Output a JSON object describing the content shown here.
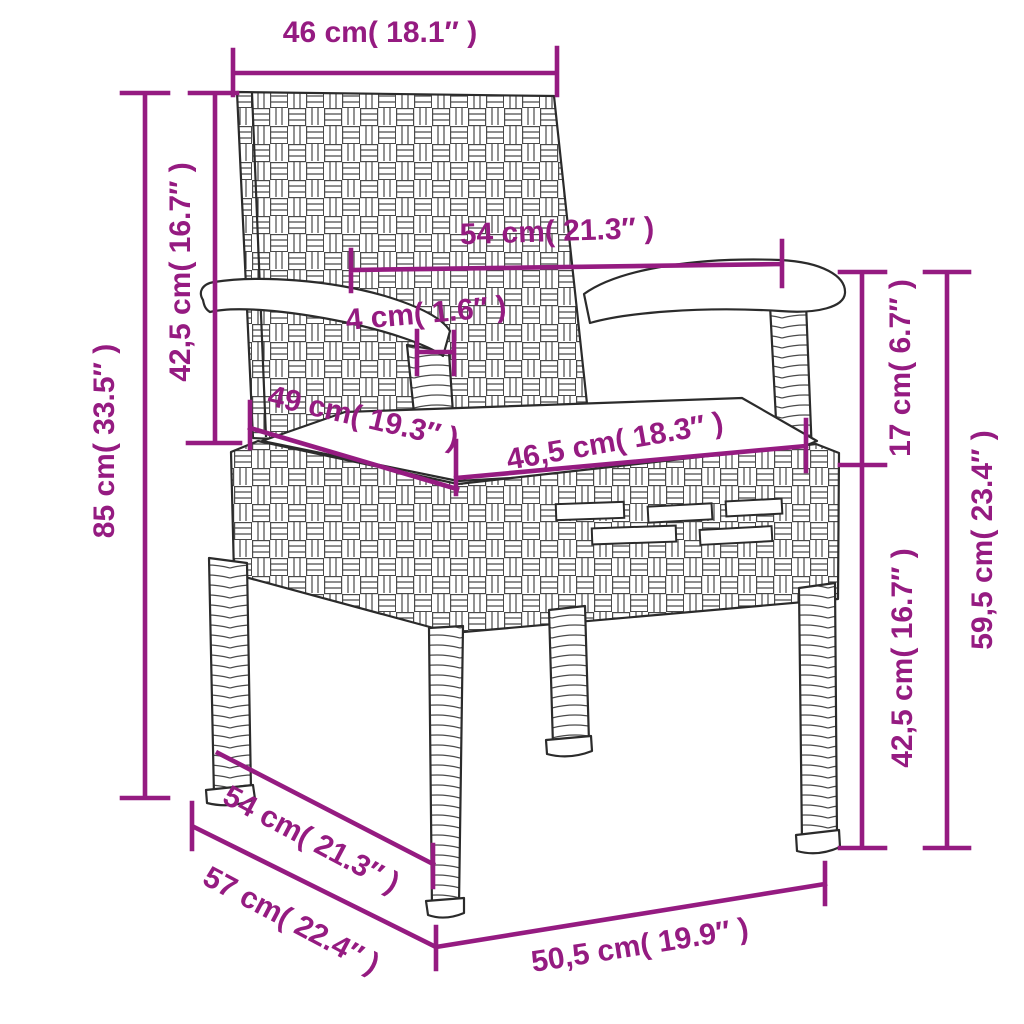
{
  "accent_color": "#951b81",
  "diagram": {
    "type": "product-dimension-diagram",
    "subject": "poly-rattan garden chair with seat cushion",
    "labels": {
      "back_width": "46 cm( 18.1″ )",
      "backrest_height": "42,5 cm( 16.7″ )",
      "overall_height": "85 cm( 33.5″ )",
      "armrest_span": "54 cm( 21.3″ )",
      "armrest_thickness": "4 cm( 1.6″ )",
      "seat_depth": "49 cm( 19.3″ )",
      "seat_width": "46,5 cm( 18.3″ )",
      "seat_to_armrest": "17 cm( 6.7″ )",
      "armrest_height": "59,5 cm( 23.4″ )",
      "seat_height": "42,5 cm( 16.7″ )",
      "base_depth": "54 cm( 21.3″ )",
      "overall_depth": "57 cm( 22.4″ )",
      "front_width": "50,5 cm( 19.9″ )"
    }
  }
}
